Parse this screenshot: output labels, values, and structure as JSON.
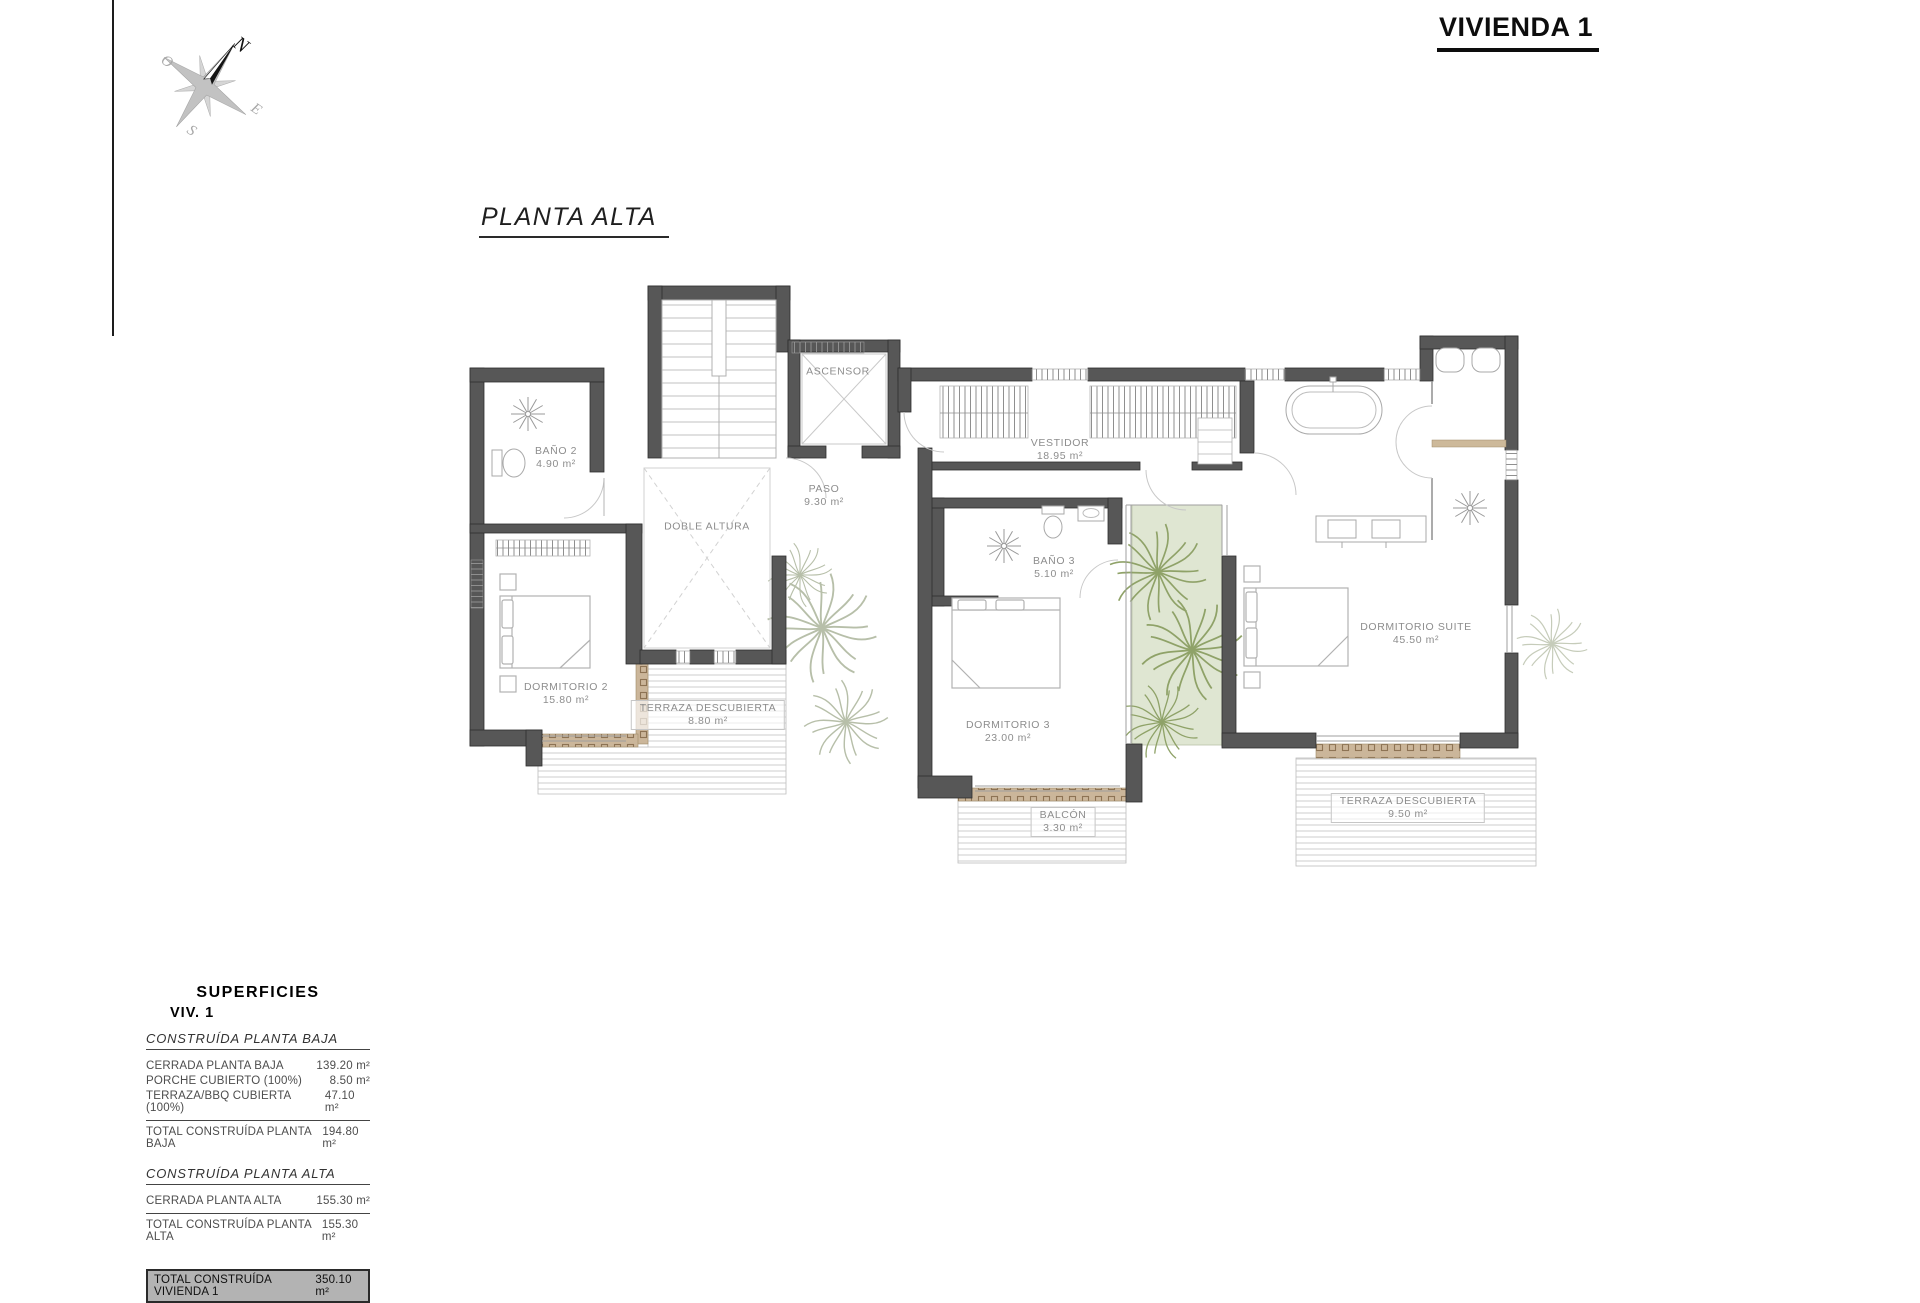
{
  "page": {
    "title": "VIVIENDA 1",
    "plan_title": "PLANTA ALTA"
  },
  "compass": {
    "n": "N",
    "s": "S",
    "e": "E",
    "o": "O"
  },
  "rooms": [
    {
      "name": "BAÑO 2",
      "area": "4.90 m²"
    },
    {
      "name": "ASCENSOR",
      "area": ""
    },
    {
      "name": "VESTIDOR",
      "area": "18.95 m²"
    },
    {
      "name": "PASO",
      "area": "9.30 m²"
    },
    {
      "name": "DOBLE ALTURA",
      "area": ""
    },
    {
      "name": "BAÑO 3",
      "area": "5.10 m²"
    },
    {
      "name": "DORMITORIO 2",
      "area": "15.80 m²"
    },
    {
      "name": "TERRAZA DESCUBIERTA",
      "area": "8.80 m²"
    },
    {
      "name": "DORMITORIO 3",
      "area": "23.00 m²"
    },
    {
      "name": "BALCÓN",
      "area": "3.30 m²"
    },
    {
      "name": "DORMITORIO SUITE",
      "area": "45.50 m²"
    },
    {
      "name": "TERRAZA DESCUBIERTA",
      "area": "9.50 m²"
    }
  ],
  "summary": {
    "heading": "SUPERFICIES",
    "subheading": "VIV. 1",
    "sections": [
      {
        "title": "CONSTRUÍDA PLANTA BAJA",
        "rows": [
          {
            "label": "CERRADA PLANTA BAJA",
            "value": "139.20 m²"
          },
          {
            "label": "PORCHE CUBIERTO (100%)",
            "value": "8.50 m²"
          },
          {
            "label": "TERRAZA/BBQ CUBIERTA (100%)",
            "value": "47.10 m²"
          }
        ],
        "total": {
          "label": "TOTAL CONSTRUÍDA PLANTA BAJA",
          "value": "194.80 m²"
        }
      },
      {
        "title": "CONSTRUÍDA PLANTA ALTA",
        "rows": [
          {
            "label": "CERRADA PLANTA ALTA",
            "value": "155.30 m²"
          }
        ],
        "total": {
          "label": "TOTAL CONSTRUÍDA PLANTA ALTA",
          "value": "155.30 m²"
        }
      }
    ],
    "grand_total": {
      "label": "TOTAL CONSTRUÍDA VIVIENDA 1",
      "value": "350.10 m²"
    }
  }
}
